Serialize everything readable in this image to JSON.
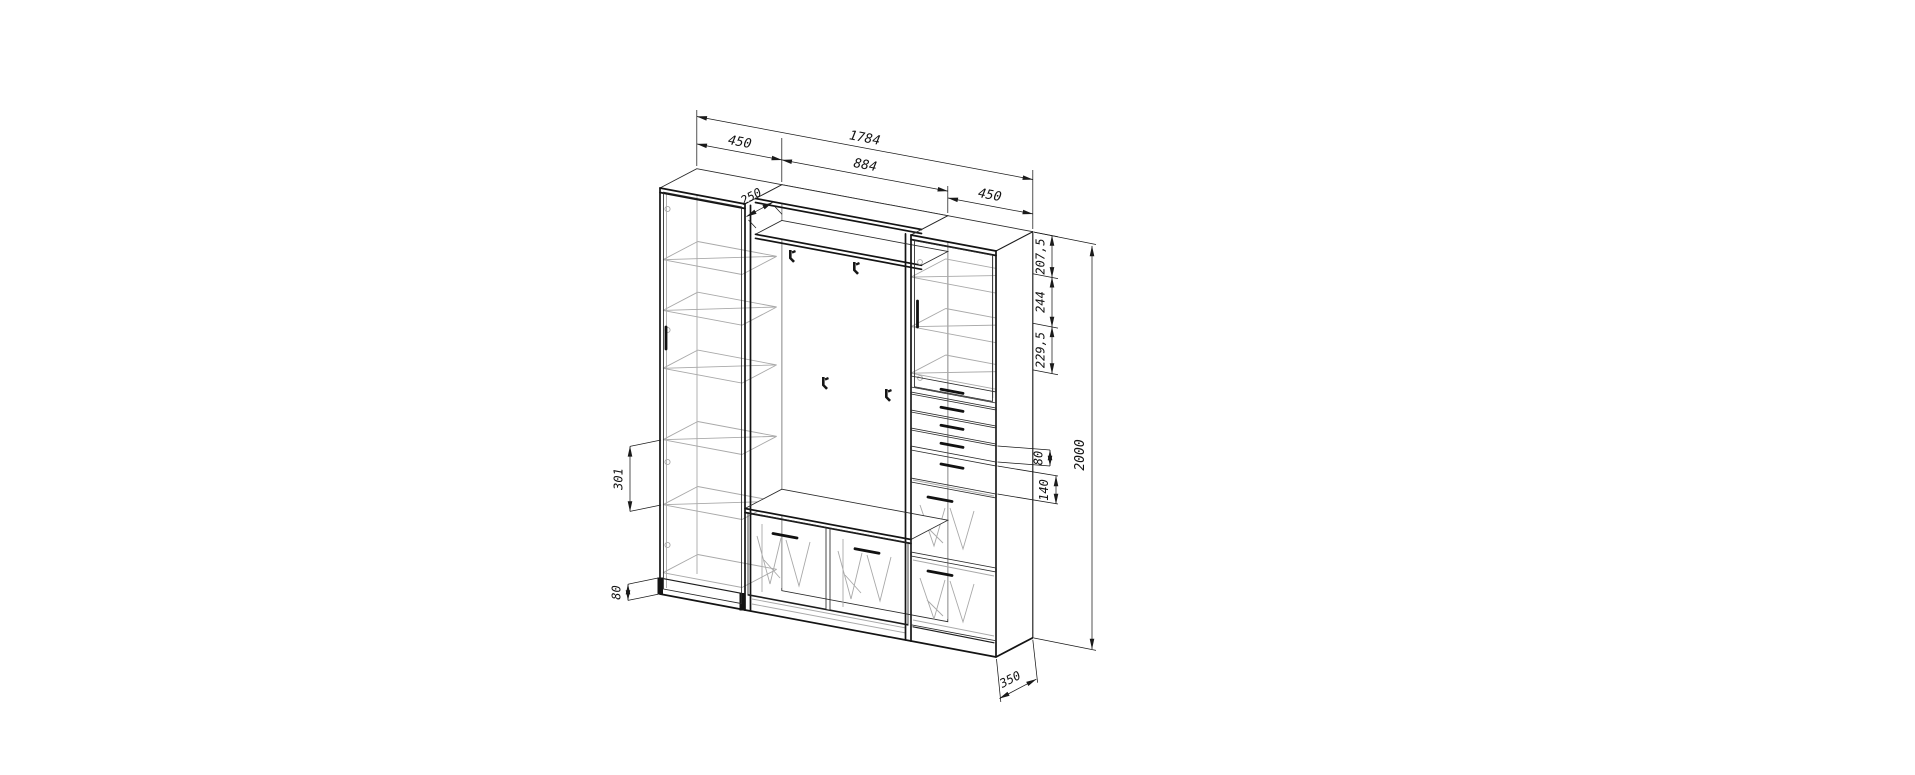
{
  "drawing": {
    "type": "furniture-technical-drawing",
    "background_color": "#ffffff",
    "line_color": "#1a1a1a",
    "hidden_line_color": "#a9a9a9",
    "dimensions": {
      "overall_width": "1784",
      "left_cabinet_width": "450",
      "middle_section_width": "884",
      "right_cabinet_width": "450",
      "top_shelf_depth": "250",
      "right_gap_top": "207,5",
      "right_gap_upper": "244",
      "right_gap_lower": "229,5",
      "drawer_front_height": "80",
      "bottom_drawer_height": "140",
      "overall_height": "2000",
      "left_shelf_spacing": "301",
      "plinth_height": "80",
      "cabinet_depth": "350"
    }
  }
}
